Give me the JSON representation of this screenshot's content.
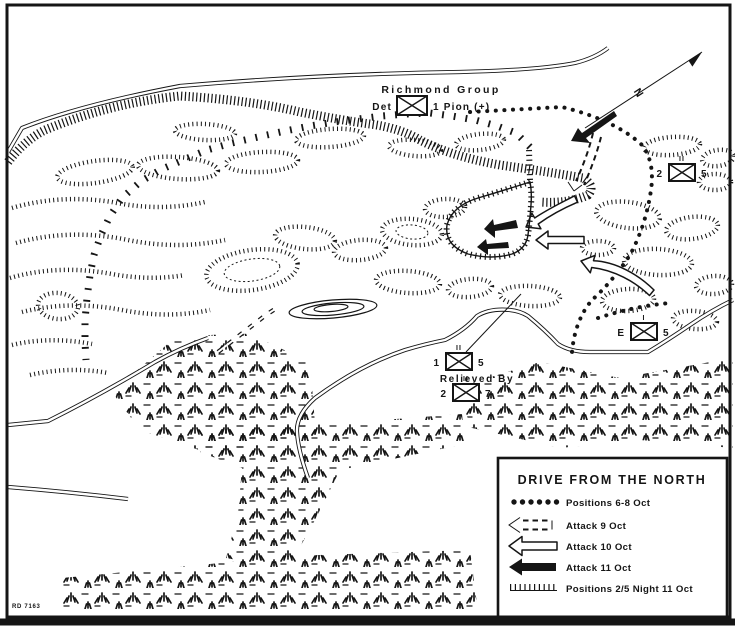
{
  "title": "DRIVE FROM THE NORTH",
  "colors": {
    "ink": "#151515",
    "paper": "#ffffff"
  },
  "labels": {
    "richmond_group": "Richmond Group",
    "relieved_by": "Relieved By",
    "north_indicator": "N",
    "drawing_number": "RD 7163"
  },
  "units": {
    "pioneer_det": {
      "prefix": "Det",
      "suffix": "1 Pion (+)",
      "size": ""
    },
    "bn_2_5": {
      "left": "2",
      "right": "5",
      "size": "II"
    },
    "co_e_5": {
      "left": "E",
      "right": "5",
      "size": "I"
    },
    "bn_1_5": {
      "left": "1",
      "right": "5",
      "size": "II"
    },
    "bn_2_7": {
      "left": "2",
      "right": "7",
      "size": "II"
    }
  },
  "legend": {
    "title": "DRIVE FROM THE NORTH",
    "entries": [
      {
        "id": "positions-6-8-oct",
        "symbol": "dotted-line",
        "label": "Positions 6-8 Oct"
      },
      {
        "id": "attack-9-oct",
        "symbol": "dashed-open-arrow",
        "label": "Attack 9 Oct"
      },
      {
        "id": "attack-10-oct",
        "symbol": "open-arrow",
        "label": "Attack 10 Oct"
      },
      {
        "id": "attack-11-oct",
        "symbol": "solid-arrow",
        "label": "Attack 11 Oct"
      },
      {
        "id": "positions-2-5-night-11-oct",
        "symbol": "hatched-line",
        "label": "Positions 2/5 Night 11 Oct"
      }
    ]
  }
}
